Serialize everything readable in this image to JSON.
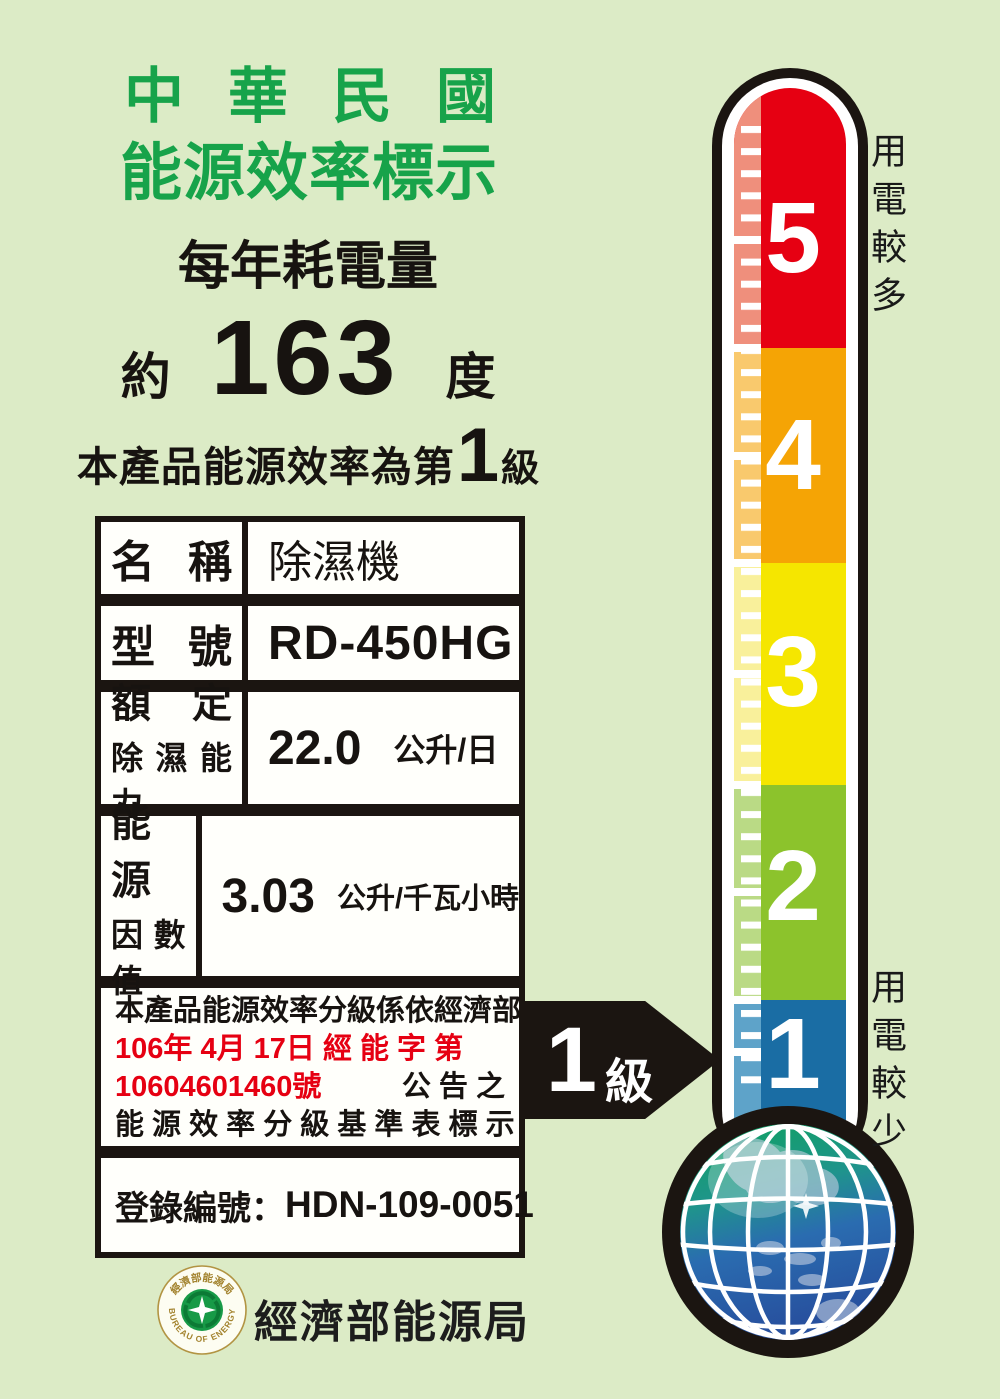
{
  "header": {
    "title_line1": "中華民國",
    "title_line2": "能源效率標示",
    "annual_heading": "每年耗電量"
  },
  "consumption": {
    "prefix": "約",
    "value": "163",
    "unit": "度"
  },
  "grade_sentence": {
    "prefix": "本產品能源效率為第",
    "grade": "1",
    "suffix": "級"
  },
  "spec_table": {
    "rows": [
      {
        "label": "名 稱",
        "value": "除濕機"
      },
      {
        "label": "型 號",
        "value": "RD-450HG"
      },
      {
        "label_line1": "額 定",
        "label_line2": "除濕能力",
        "value": "22.0",
        "unit": "公升/日"
      },
      {
        "label_line1": "能 源",
        "label_line2": "因數值",
        "value": "3.03",
        "unit": "公升/千瓦小時"
      }
    ],
    "statement": {
      "line1": "本產品能源效率分級係依經濟部",
      "line2": "106年 4月 17日 經 能 字 第",
      "line3_red": "10604601460號",
      "line3_black": "公 告 之",
      "line4": "能 源 效 率 分 級 基 準 表 標 示"
    },
    "registration": {
      "label": "登錄編號：",
      "value": "HDN-109-0051"
    }
  },
  "grade_arrow": {
    "grade": "1",
    "unit": "級"
  },
  "thermometer": {
    "label_top": "用電較多",
    "label_bottom": "用電較少",
    "scale": [
      {
        "grade": "5",
        "color": "#e60012",
        "tint": "#ef8f7c"
      },
      {
        "grade": "4",
        "color": "#f5a405",
        "tint": "#f9c96d"
      },
      {
        "grade": "3",
        "color": "#f5e600",
        "tint": "#f9f09b"
      },
      {
        "grade": "2",
        "color": "#8cc32c",
        "tint": "#bada85"
      },
      {
        "grade": "1",
        "color": "#1a6da4",
        "tint": "#5ea3c9"
      }
    ]
  },
  "footer": {
    "seal_arc_top": "經濟部能源局",
    "seal_arc_bottom": "BUREAU OF ENERGY",
    "agency_name": "經濟部能源局"
  },
  "colors": {
    "background": "#dcebc6",
    "title_green": "#17a34a",
    "statement_red": "#e60012",
    "ink": "#1b1511"
  }
}
